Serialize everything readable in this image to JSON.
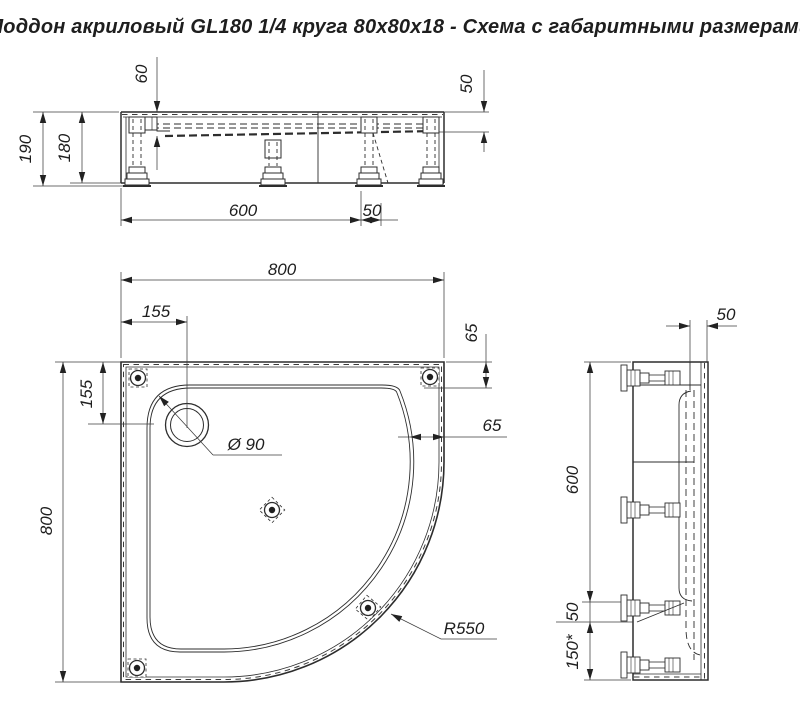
{
  "title": "Поддон акриловый  GL180 1/4 круга 80x80x18 - Схема с габаритными размерами",
  "front_view": {
    "dims": {
      "basin_depth": "60",
      "rim_width": "50",
      "total_height": "190",
      "body_height": "180",
      "foot_span": "600",
      "foot_offset": "50"
    }
  },
  "plan_view": {
    "dims": {
      "overall_width": "800",
      "drain_offset_x": "155",
      "rim_top": "65",
      "drain_offset_y": "155",
      "overall_depth": "800",
      "rim_side": "65",
      "drain_diameter": "Ø 90",
      "corner_radius": "R550"
    }
  },
  "side_view": {
    "dims": {
      "rim_width": "50",
      "upper_span": "600",
      "foot_gap": "50",
      "bottom_span": "150*"
    }
  }
}
